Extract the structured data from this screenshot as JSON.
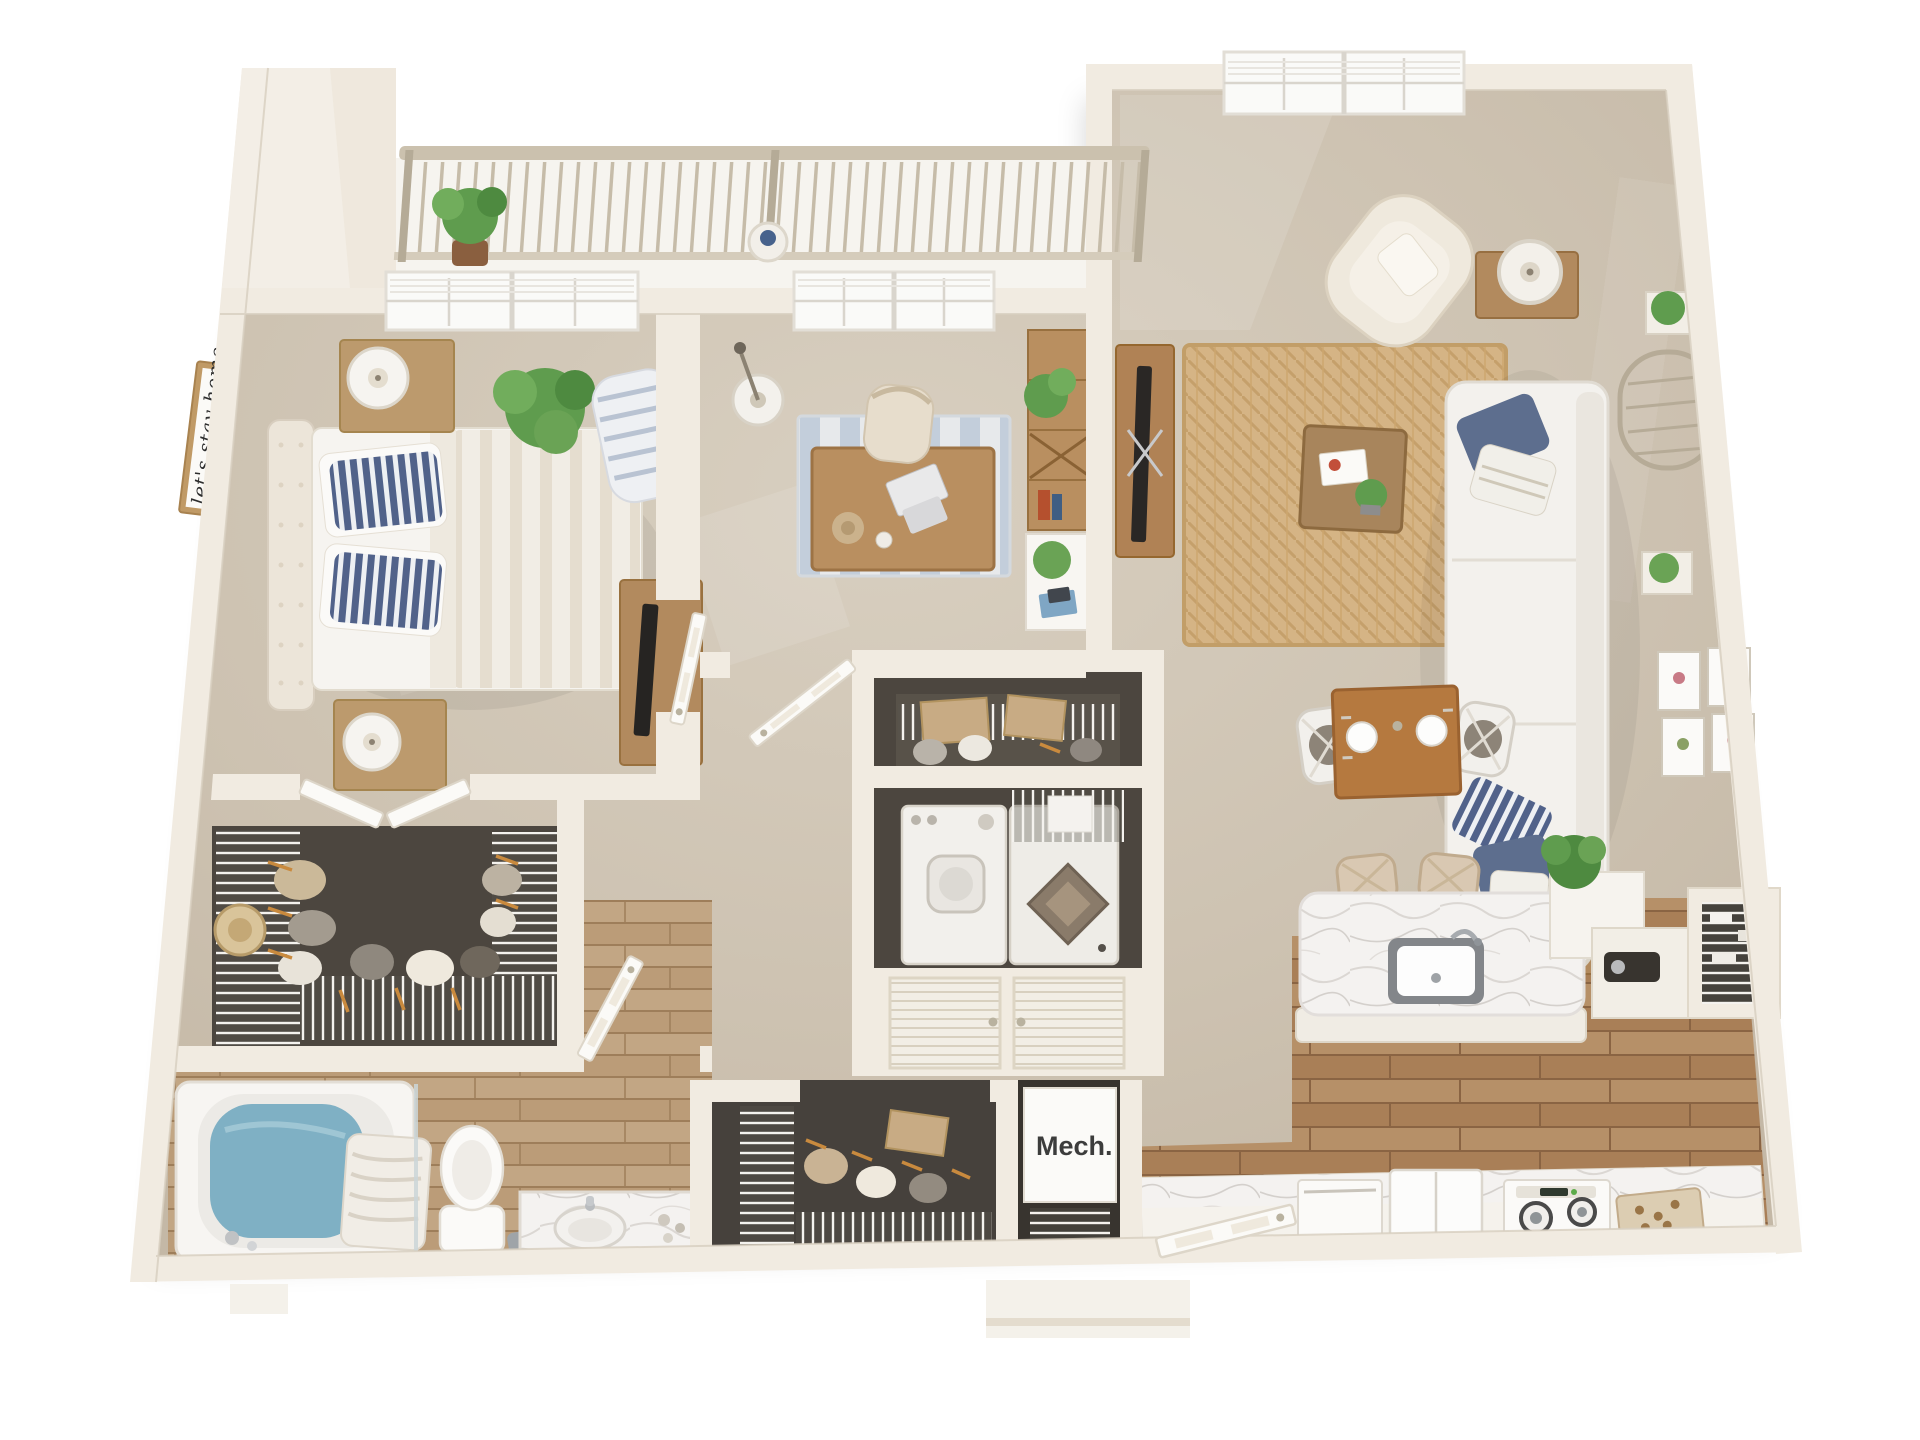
{
  "scene": {
    "type": "3d-floor-plan-rendering"
  },
  "labels": {
    "mech": "Mech.",
    "wall_sign": "let's stay home"
  },
  "colors": {
    "background": "#ffffff",
    "wall": "#f1ebe1",
    "wall_shade": "#ded4c4",
    "carpet": "#cdc2b1",
    "closet_carpet": "#4c463f",
    "wood_floor": "#b08a63",
    "wood_floor_light": "#c2a684",
    "marble": "#f4f2f0",
    "tub_water": "#7fb0c4",
    "sofa_white": "#f3f1ed",
    "pillow_navy": "#5d6e8e",
    "jute_rug": "#d5b485",
    "office_rug_blue": "#c3cedb",
    "furniture_wood": "#b28a5e",
    "dining_wood": "#b5793f",
    "plant_green": "#5f9c4e",
    "hanger_orange": "#c98a3e",
    "railing_tan": "#c6bca9"
  }
}
